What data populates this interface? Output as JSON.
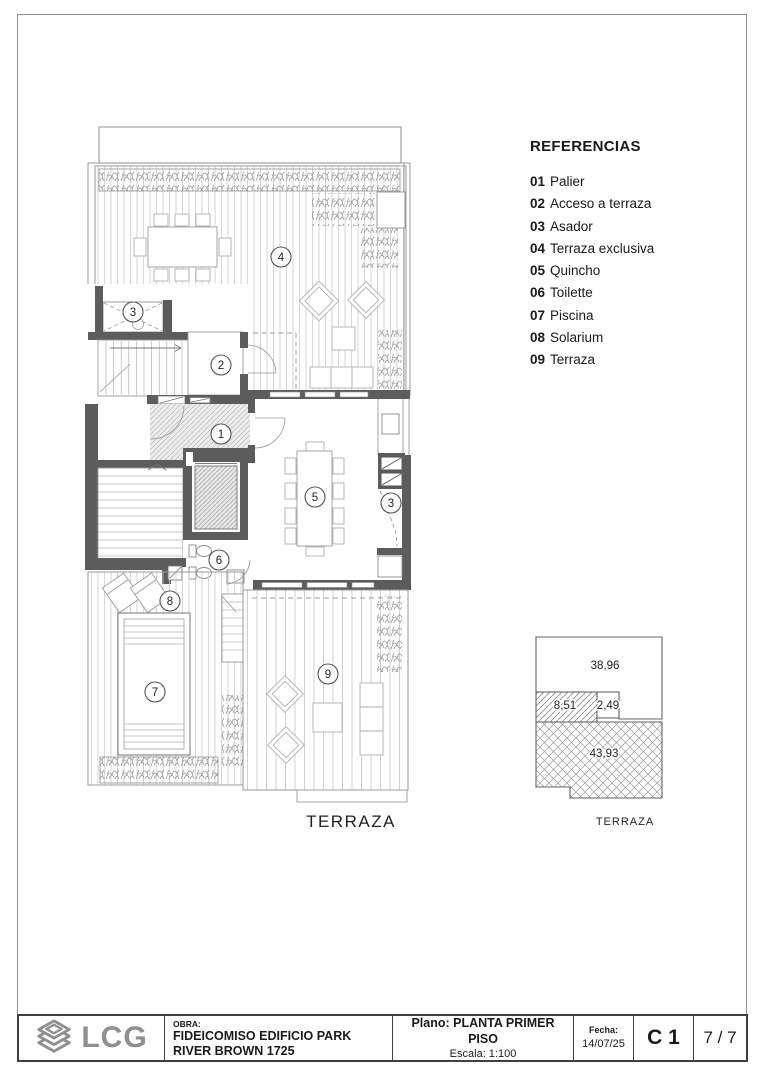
{
  "references": {
    "title": "REFERENCIAS",
    "items": [
      {
        "num": "01",
        "label": "Palier"
      },
      {
        "num": "02",
        "label": "Acceso a terraza"
      },
      {
        "num": "03",
        "label": "Asador"
      },
      {
        "num": "04",
        "label": "Terraza exclusiva"
      },
      {
        "num": "05",
        "label": "Quincho"
      },
      {
        "num": "06",
        "label": "Toilette"
      },
      {
        "num": "07",
        "label": "Piscina"
      },
      {
        "num": "08",
        "label": "Solarium"
      },
      {
        "num": "09",
        "label": "Terraza"
      }
    ]
  },
  "plan": {
    "label": "TERRAZA",
    "bubbles": [
      {
        "n": "4"
      },
      {
        "n": "3"
      },
      {
        "n": "2"
      },
      {
        "n": "1"
      },
      {
        "n": "5"
      },
      {
        "n": "3"
      },
      {
        "n": "6"
      },
      {
        "n": "8"
      },
      {
        "n": "7"
      },
      {
        "n": "9"
      }
    ]
  },
  "key_diagram": {
    "areas": [
      {
        "value": "38,96"
      },
      {
        "value": "8,51"
      },
      {
        "value": "2,49"
      },
      {
        "value": "43,93"
      }
    ],
    "label": "TERRAZA"
  },
  "titleblock": {
    "logo": "LCG",
    "obra_label": "OBRA:",
    "obra_value": "FIDEICOMISO EDIFICIO PARK RIVER BROWN 1725",
    "plano_label": "Plano:",
    "plano_value": "PLANTA PRIMER PISO",
    "escala": "Escala: 1:100",
    "fecha_label": "Fecha:",
    "fecha_value": "14/07/25",
    "code": "C 1",
    "pages": "7 / 7"
  },
  "colors": {
    "wall": "#5c5c5c",
    "logo_gray": "#8f8f8f",
    "line_gray": "#969696"
  }
}
